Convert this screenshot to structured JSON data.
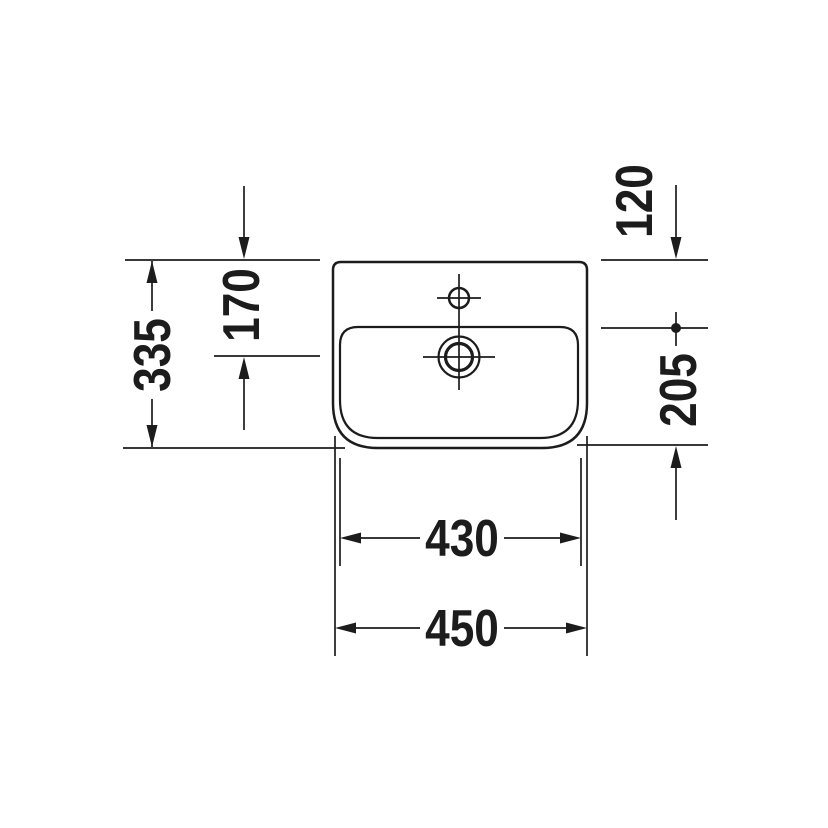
{
  "colors": {
    "ink": "#1c1c1c",
    "paper": "#ffffff"
  },
  "drawing": {
    "dims": {
      "left_outer": "335",
      "left_inner": "170",
      "top_right": "120",
      "right": "205",
      "bottom_inner": "430",
      "bottom_outer": "450"
    }
  }
}
